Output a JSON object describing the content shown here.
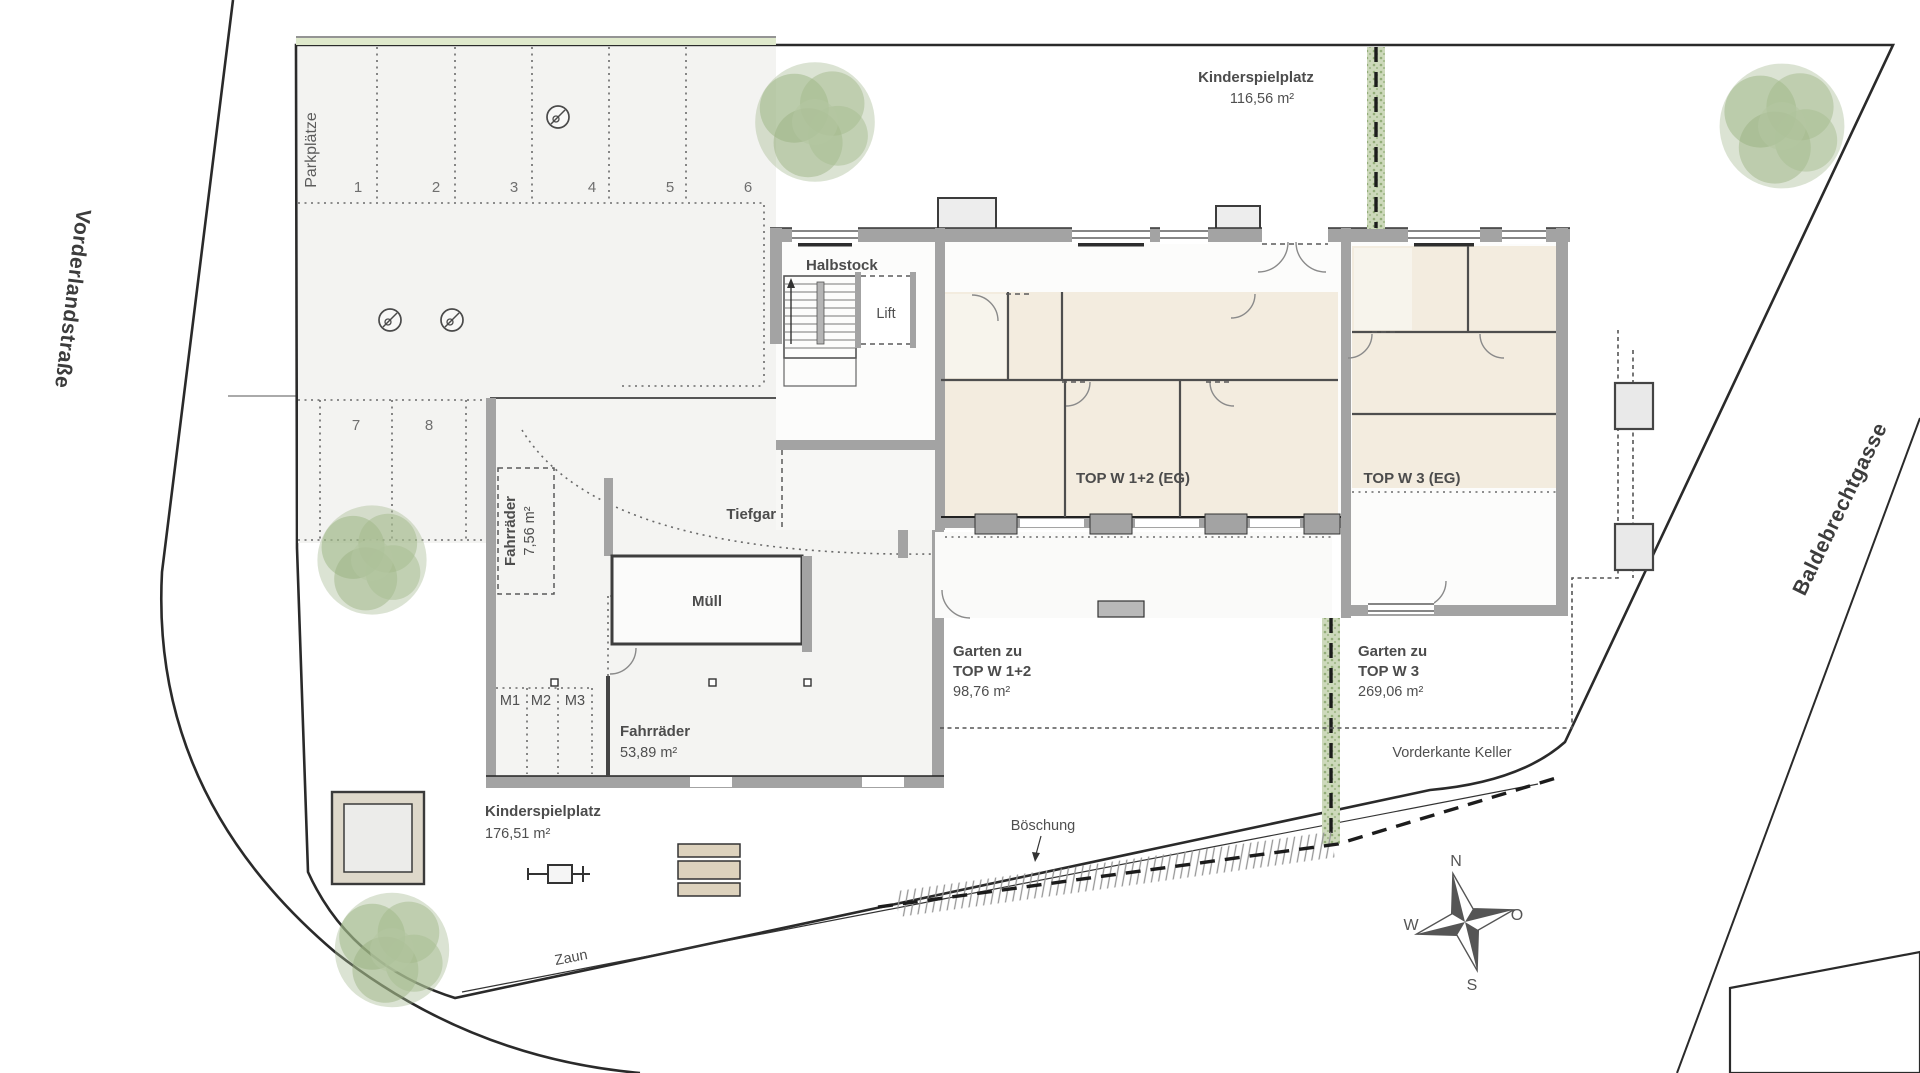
{
  "site": {
    "streets": {
      "left": "Vorderlandstraße",
      "right": "Baldebrechtgasse"
    },
    "compass": {
      "n": "N",
      "e": "O",
      "s": "S",
      "w": "W"
    },
    "fence_label": "Zaun",
    "slope_label": "Böschung",
    "basement_label": "Vorderkante Keller"
  },
  "parking": {
    "label": "Parkplätze",
    "row1": [
      "1",
      "2",
      "3",
      "4",
      "5",
      "6"
    ],
    "row2": [
      "7",
      "8"
    ],
    "moto": [
      "M1",
      "M2",
      "M3"
    ]
  },
  "garage": {
    "bike_small": {
      "name": "Fahrräder",
      "area": "7,56 m²"
    },
    "bike_large": {
      "name": "Fahrräder",
      "area": "53,89 m²"
    },
    "waste": "Müll",
    "ramp": {
      "line1": "Überdachte",
      "line2": "Tiefgaragenabfahrt"
    },
    "gate": "TG-Tor"
  },
  "building": {
    "halffloor": "Halbstock",
    "lift": "Lift",
    "unit12": "TOP W 1+2 (EG)",
    "unit3": "TOP W 3 (EG)"
  },
  "areas": {
    "play_top": {
      "name": "Kinderspielplatz",
      "area": "116,56 m²"
    },
    "play_bottom": {
      "name": "Kinderspielplatz",
      "area": "176,51 m²"
    },
    "garden12": {
      "line1": "Garten zu",
      "line2": "TOP W 1+2",
      "area": "98,76 m²"
    },
    "garden3": {
      "line1": "Garten zu",
      "line2": "TOP W 3",
      "area": "269,06 m²"
    }
  },
  "colors": {
    "site_green": "#e6eed8",
    "hedge_green": "#cdd9bb",
    "wall_gray": "#a3a3a3",
    "room_beige": "#f3ecdf",
    "paper": "#ffffff",
    "line_dark": "#2a2a2a",
    "tree_green": "#a3b88e"
  }
}
